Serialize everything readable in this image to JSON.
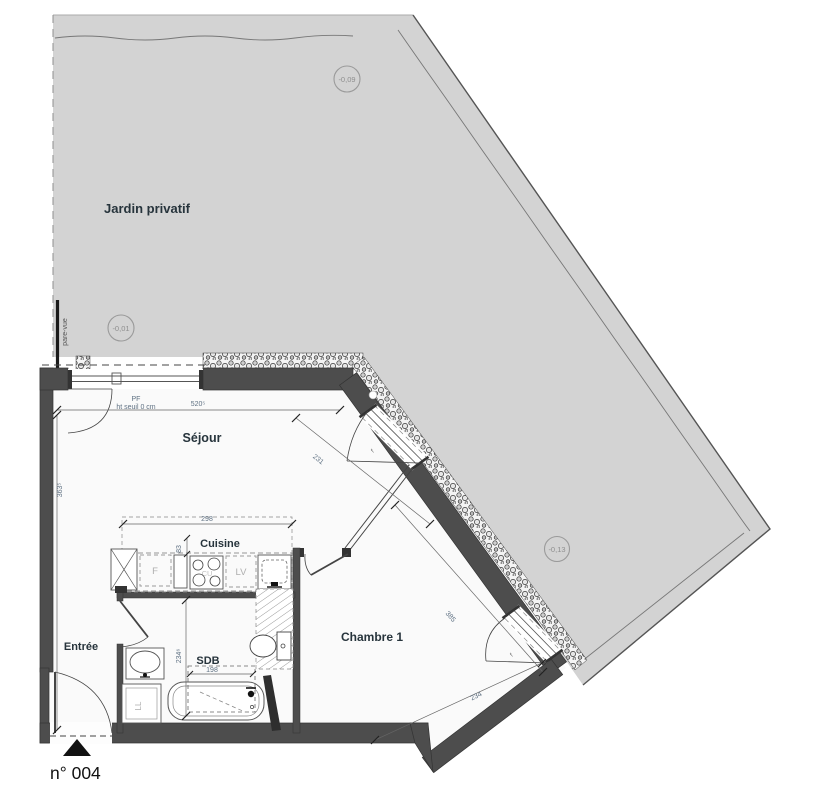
{
  "plan": {
    "unit_number": "n° 004",
    "garden": {
      "label": "Jardin privatif",
      "screen_label": "pare-vue"
    },
    "levels": [
      {
        "value": "-0,09"
      },
      {
        "value": "-0,01"
      },
      {
        "value": "-0,13"
      }
    ],
    "rooms": [
      {
        "name": "Séjour"
      },
      {
        "name": "Cuisine"
      },
      {
        "name": "Entrée"
      },
      {
        "name": "SDB"
      },
      {
        "name": "Chambre 1"
      }
    ],
    "openings": {
      "pf_label": "PF",
      "pf_threshold": "ht seuil 0 cm",
      "window_leaf": "f"
    },
    "fixtures": {
      "fridge": "F",
      "dishwasher": "LV",
      "washer": "LL",
      "hob": "CU"
    },
    "dimensions": {
      "sejour_width": "520⁵",
      "sejour_height": "363⁵",
      "cuisine_width": "298",
      "cuisine_depth": "83",
      "sejour_diag": "231",
      "chambre_length": "385",
      "chambre_width": "234",
      "sdb_height": "234⁶",
      "sdb_width": "198"
    },
    "colors": {
      "garden": "#d3d3d3",
      "wall": "#4d4d4d",
      "label": "#27343c",
      "dimension": "#5f7183",
      "level": "#8f8f8f"
    }
  }
}
